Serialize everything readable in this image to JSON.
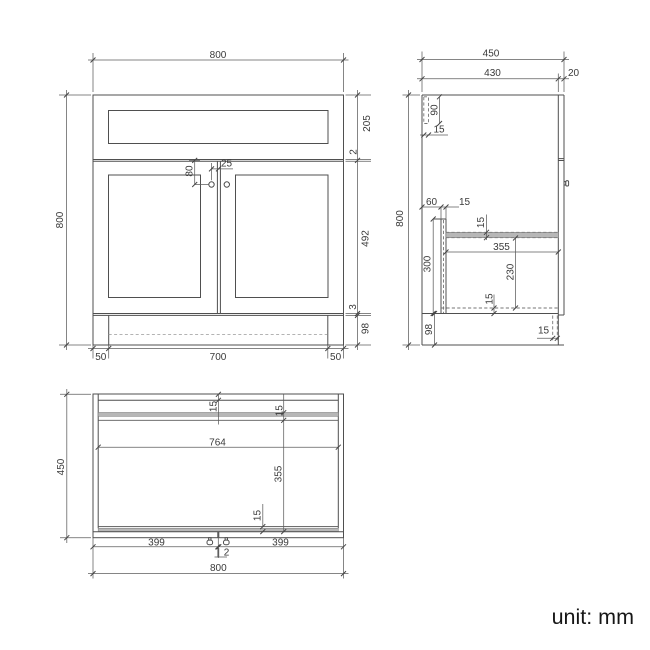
{
  "unit_label": "unit: mm",
  "front": {
    "width": "800",
    "height": "800",
    "drawer_front_height": "205",
    "drawer_door_gap": "2",
    "door_height": "492",
    "door_bottom_gap": "3",
    "plinth_height": "98",
    "handle_drop": "80",
    "handle_offset": "25",
    "plinth_inset_left": "50",
    "plinth_width": "700",
    "plinth_inset_right": "50"
  },
  "side": {
    "depth": "450",
    "carcass_depth": "430",
    "front_thickness": "20",
    "height": "800",
    "back_rail_height": "90",
    "back_rail_thickness": "15",
    "service_void": "60",
    "support_thickness": "15",
    "support_height": "300",
    "shelf_thickness": "15",
    "shelf_depth": "355",
    "under_shelf_height": "230",
    "bottom_panel_thickness": "15",
    "plinth_height": "98",
    "plinth_board_thickness": "15"
  },
  "plan": {
    "depth": "450",
    "back_panel_thickness": "15",
    "back_rail_thickness": "15",
    "internal_width": "764",
    "internal_depth": "355",
    "front_rail_thickness": "15",
    "left_door_width": "399",
    "door_gap": "2",
    "right_door_width": "399",
    "width": "800"
  }
}
